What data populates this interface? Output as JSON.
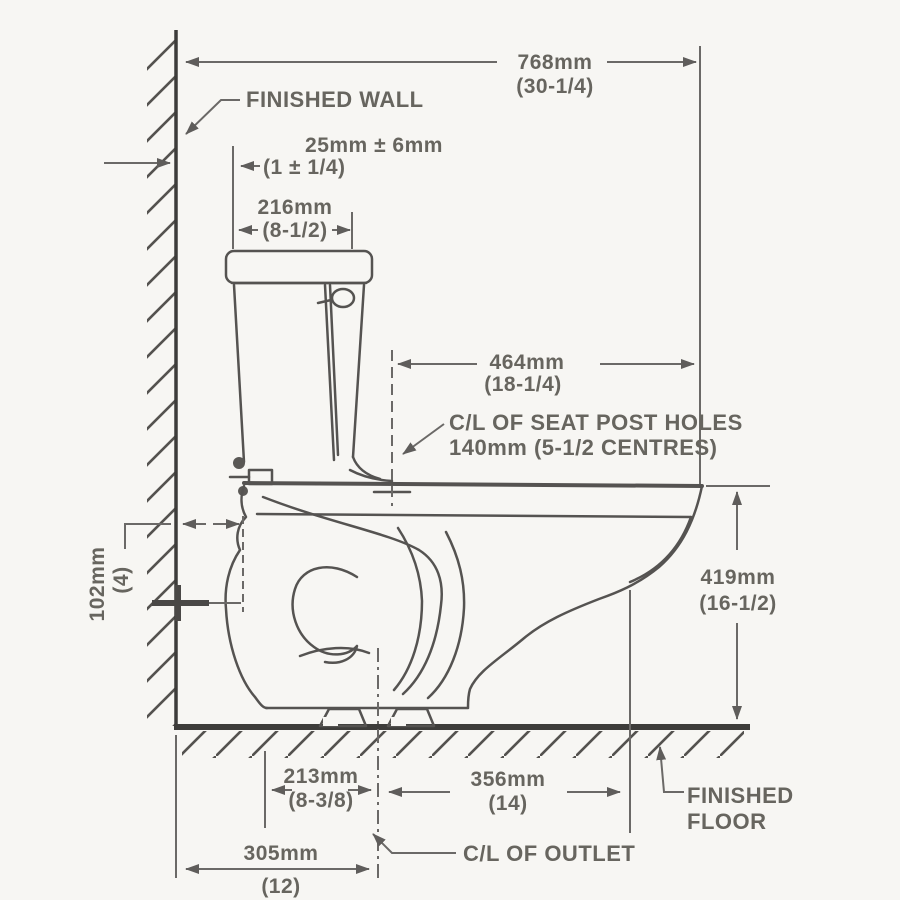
{
  "title": "Toilet rough-in installation dimensions (side view)",
  "labels": {
    "finished_wall": "FINISHED WALL",
    "finished_floor_1": "FINISHED",
    "finished_floor_2": "FLOOR",
    "cl_outlet": "C/L OF OUTLET",
    "cl_seat_1": "C/L OF SEAT POST HOLES",
    "cl_seat_2": "140mm (5-1/2 CENTRES)"
  },
  "dims": {
    "d768": {
      "mm": "768mm",
      "in": "(30-1/4)"
    },
    "d25": {
      "mm": "25mm ± 6mm",
      "in": "(1 ± 1/4)"
    },
    "d216": {
      "mm": "216mm",
      "in": "(8-1/2)"
    },
    "d464": {
      "mm": "464mm",
      "in": "(18-1/4)"
    },
    "d419": {
      "mm": "419mm",
      "in": "(16-1/2)"
    },
    "d102": {
      "mm": "102mm",
      "in": "(4)"
    },
    "d213": {
      "mm": "213mm",
      "in": "(8-3/8)"
    },
    "d356": {
      "mm": "356mm",
      "in": "(14)"
    },
    "d305": {
      "mm": "305mm",
      "in": "(12)"
    }
  },
  "colors": {
    "line_art": "#555351",
    "structure": "#3d3c3a",
    "dimension": "#6b6967",
    "text": "#67655f",
    "background": "#f7f6f3"
  }
}
